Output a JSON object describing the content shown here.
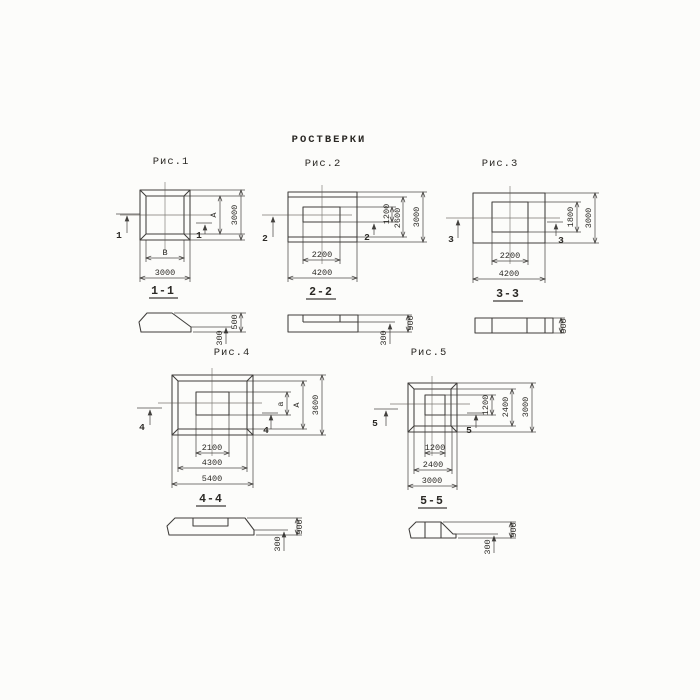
{
  "colors": {
    "ink": "#2f2d2a",
    "paper": "#fcfcfa"
  },
  "title": "РОСТВЕРКИ",
  "figures": {
    "fig1": {
      "caption": "Рис.1",
      "cut_mark": "1",
      "section_title": "1-1",
      "plan": {
        "height_label": "А",
        "width_label": "В",
        "height_total": "3000",
        "width_total": "3000"
      },
      "section": {
        "total_height": "500",
        "step_height": "300"
      }
    },
    "fig2": {
      "caption": "Рис.2",
      "cut_mark": "2",
      "section_title": "2-2",
      "plan": {
        "inner_height": "1200",
        "mid_height": "2600",
        "total_height": "3000",
        "inner_width": "2200",
        "total_width": "4200"
      },
      "section": {
        "total_height": "900",
        "step_height": "300"
      }
    },
    "fig3": {
      "caption": "Рис.3",
      "cut_mark": "3",
      "section_title": "3-3",
      "plan": {
        "inner_height": "1800",
        "total_height": "3000",
        "inner_width": "2200",
        "total_width": "4200"
      },
      "section": {
        "total_height": "900"
      }
    },
    "fig4": {
      "caption": "Рис.4",
      "cut_mark": "4",
      "section_title": "4-4",
      "plan": {
        "inner_height_label": "а",
        "mid_height_label": "А",
        "total_height": "3600",
        "inner_width": "2100",
        "mid_width": "4300",
        "total_width": "5400"
      },
      "section": {
        "total_height": "900",
        "step_height": "300"
      }
    },
    "fig5": {
      "caption": "Рис.5",
      "cut_mark": "5",
      "section_title": "5-5",
      "plan": {
        "inner_height": "1200",
        "mid_height": "2400",
        "total_height": "3000",
        "inner_width": "1200",
        "mid_width": "2400",
        "total_width": "3000"
      },
      "section": {
        "total_height": "900",
        "step_height": "300"
      }
    }
  }
}
